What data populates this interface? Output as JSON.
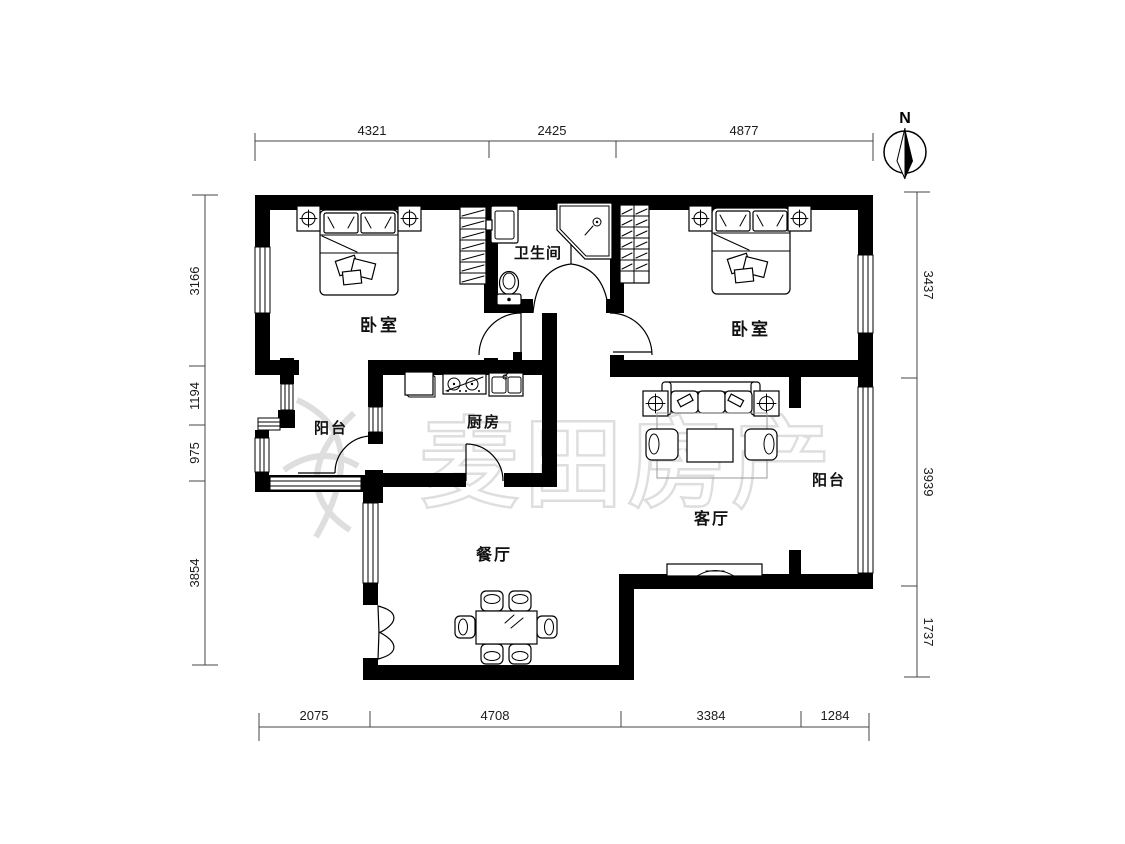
{
  "dimensions": {
    "top": [
      "4321",
      "2425",
      "4877"
    ],
    "bottom": [
      "2075",
      "4708",
      "3384",
      "1284"
    ],
    "left": [
      "3166",
      "1194",
      "975",
      "3854"
    ],
    "right": [
      "3437",
      "3939",
      "1737"
    ]
  },
  "rooms": {
    "bedroom_left": "卧室",
    "bathroom": "卫生间",
    "bedroom_right": "卧室",
    "balcony_left": "阳台",
    "kitchen": "厨房",
    "living_room": "客厅",
    "balcony_right": "阳台",
    "dining_room": "餐厅"
  },
  "compass": {
    "north_label": "N"
  },
  "watermark": {
    "brand_text": "麦田房产"
  },
  "colors": {
    "wall": "#000000",
    "watermark_stroke": "#dedede",
    "background": "#ffffff"
  }
}
